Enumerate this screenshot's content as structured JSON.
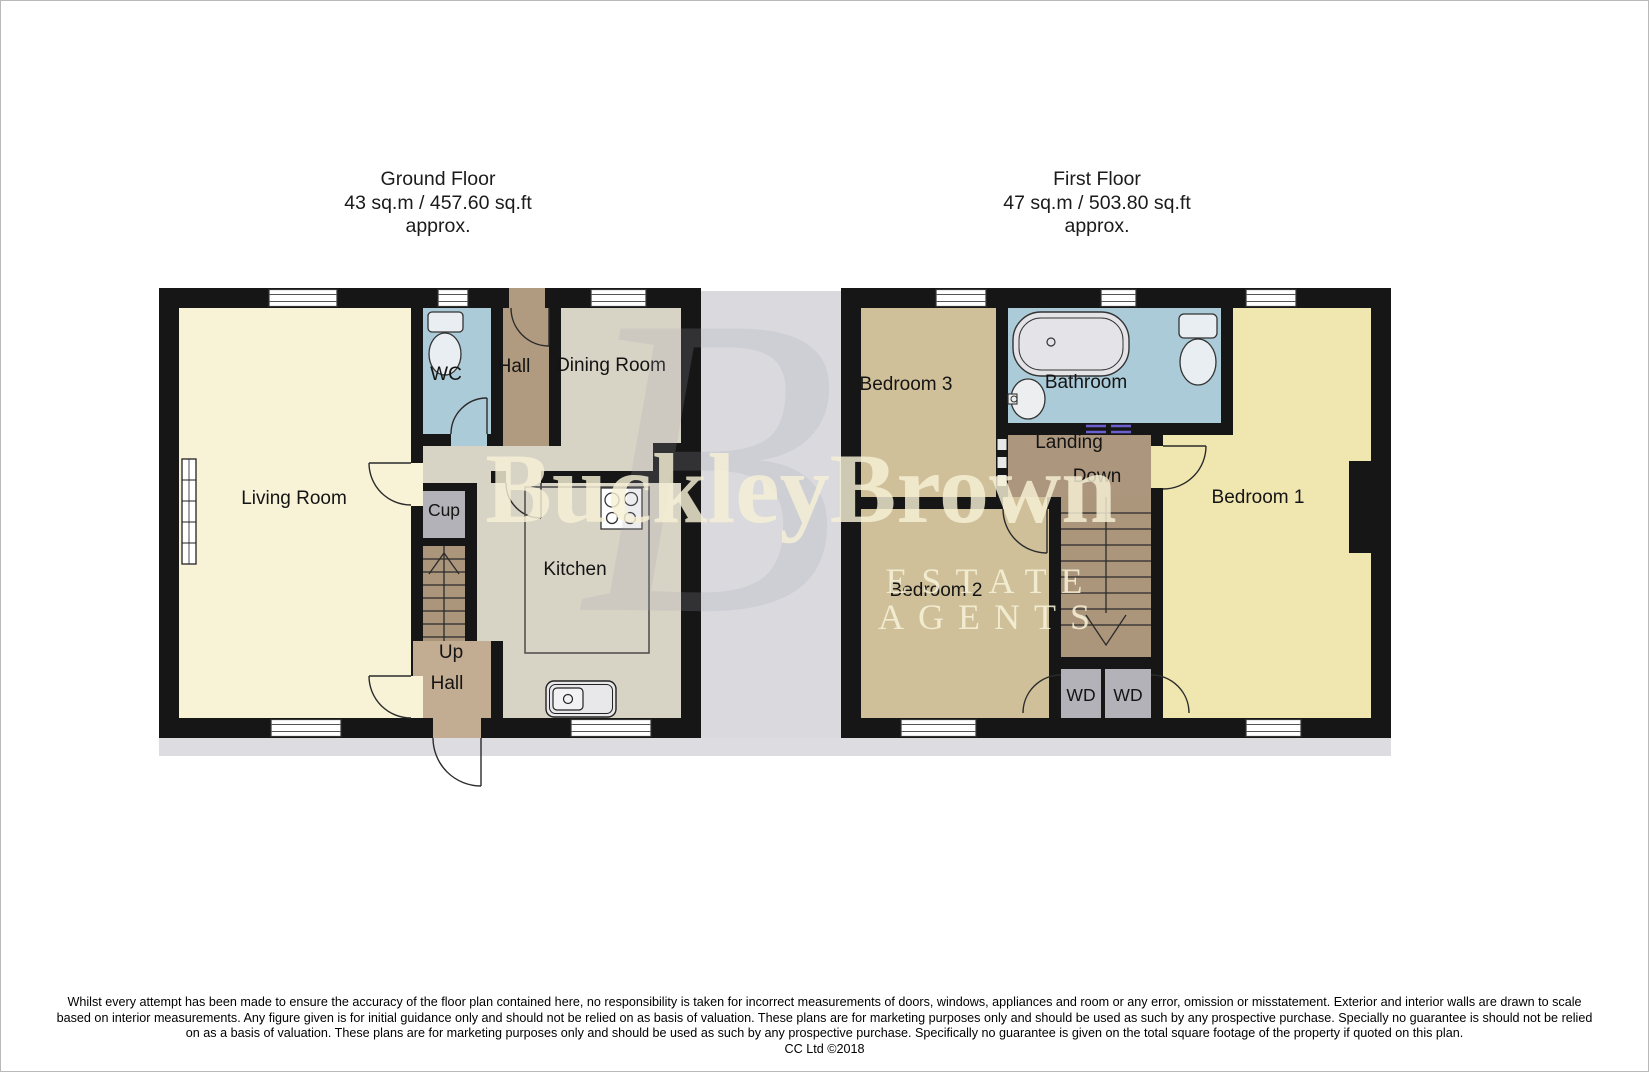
{
  "titles": {
    "ground_floor": {
      "name": "Ground Floor",
      "area": "43 sq.m / 457.60 sq.ft",
      "approx": "approx."
    },
    "first_floor": {
      "name": "First Floor",
      "area": "47 sq.m / 503.80 sq.ft",
      "approx": "approx."
    }
  },
  "ground_floor": {
    "rooms": {
      "living_room": "Living Room",
      "wc": "WC",
      "hall_top": "Hall",
      "dining_room": "Dining Room",
      "cup": "Cup",
      "kitchen": "Kitchen",
      "up": "Up",
      "hall_bottom": "Hall"
    }
  },
  "first_floor": {
    "rooms": {
      "bedroom_3": "Bedroom 3",
      "bathroom": "Bathroom",
      "landing": "Landing",
      "down": "Down",
      "bedroom_1": "Bedroom 1",
      "bedroom_2": "Bedroom 2",
      "wd_left": "WD",
      "wd_right": "WD"
    }
  },
  "watermark": {
    "monogram": "B",
    "brand": "BuckleyBrown",
    "tagline": "ESTATE AGENTS"
  },
  "disclaimer": {
    "line1": "Whilst every attempt has been made to ensure the accuracy of the floor plan contained here, no responsibility is taken for incorrect measurements of doors, windows, appliances and room or any error, omission or misstatement. Exterior and interior walls are drawn to scale",
    "line2": "based on interior measurements. Any figure given is for initial guidance only and should not be relied on as basis of valuation. These plans are for marketing purposes only and should be used as such by any prospective purchase. Specially no guarantee is should not be relied",
    "line3": "on as a basis of valuation. These plans are for marketing purposes only and should be used as such by any prospective purchase. Specifically no guarantee is given on the total square footage of the property if quoted on this plan.",
    "line4": "CC Ltd ©2018"
  },
  "colors": {
    "wall": "#161616",
    "living_room": "#f8f3d7",
    "wc_bathroom": "#accbd8",
    "hall_top": "#b19b80",
    "hall_entry": "#c3ad92",
    "kitchen_dining": "#d7d3c5",
    "cupboard_wardrobe": "#b2b2b8",
    "stairs": "#ab967c",
    "landing": "#ac977e",
    "bedroom_1": "#f0e6b0",
    "bedroom_2_3": "#cfc09a",
    "internal_window": "#6b5ece",
    "watermark_gray": "#d9d9de",
    "watermark_cream": "#f6f0d6"
  }
}
